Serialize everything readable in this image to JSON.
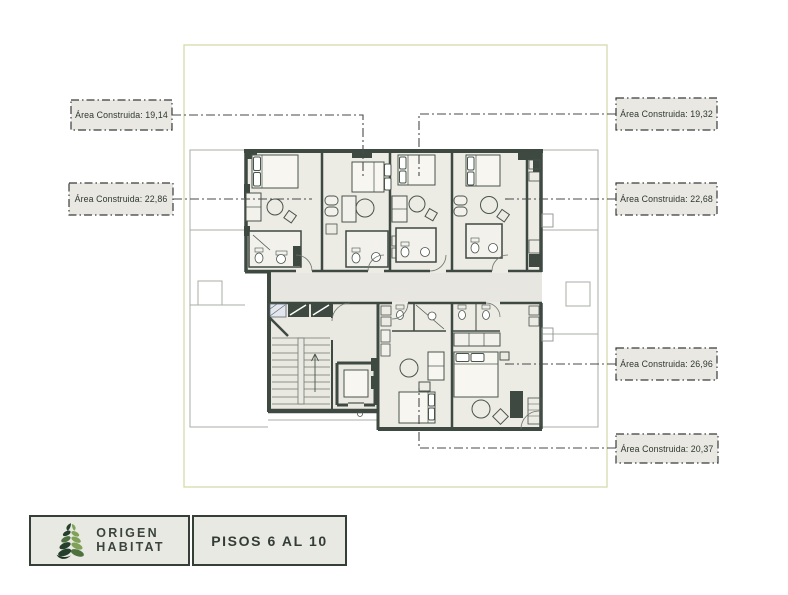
{
  "plan": {
    "type": "architectural-floor-plan",
    "boundary_color": "#d6daae",
    "wall_color": "#3e4942",
    "floor_color": "#ecebe4",
    "label_box_bg": "#e9e8e2"
  },
  "area_labels": {
    "left": [
      "Área Construida: 19,14",
      "Área Construida: 22,86"
    ],
    "right": [
      "Área Construida: 19,32",
      "Área Construida: 22,68",
      "Área Construida: 26,96",
      "Área Construida: 20,37"
    ]
  },
  "footer": {
    "brand_line1": "ORIGEN",
    "brand_line2": "HABITAT",
    "floor_label": "PISOS 6 AL 10",
    "leaf_dark": "#24402d",
    "leaf_light": "#7fa258"
  }
}
